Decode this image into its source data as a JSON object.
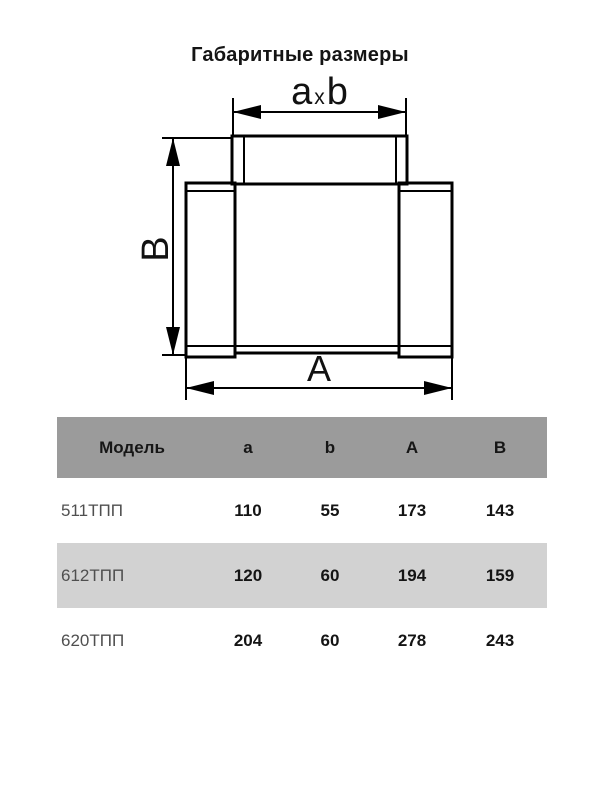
{
  "title": "Габаритные размеры",
  "diagram": {
    "dim_top": {
      "a": "a",
      "x": "x",
      "b": "b"
    },
    "dim_left": "B",
    "dim_bottom": "A"
  },
  "table": {
    "columns": [
      "Модель",
      "a",
      "b",
      "A",
      "B"
    ],
    "rows": [
      {
        "model": "511ТПП",
        "a": "110",
        "b": "55",
        "A": "173",
        "B": "143"
      },
      {
        "model": "612ТПП",
        "a": "120",
        "b": "60",
        "A": "194",
        "B": "159"
      },
      {
        "model": "620ТПП",
        "a": "204",
        "b": "60",
        "A": "278",
        "B": "243"
      }
    ]
  },
  "colors": {
    "header_bg": "#9b9b9b",
    "row_alt_bg": "#d2d2d2",
    "line": "#000000",
    "text_dark": "#1c1c1c",
    "text_model": "#4f4f4f"
  }
}
